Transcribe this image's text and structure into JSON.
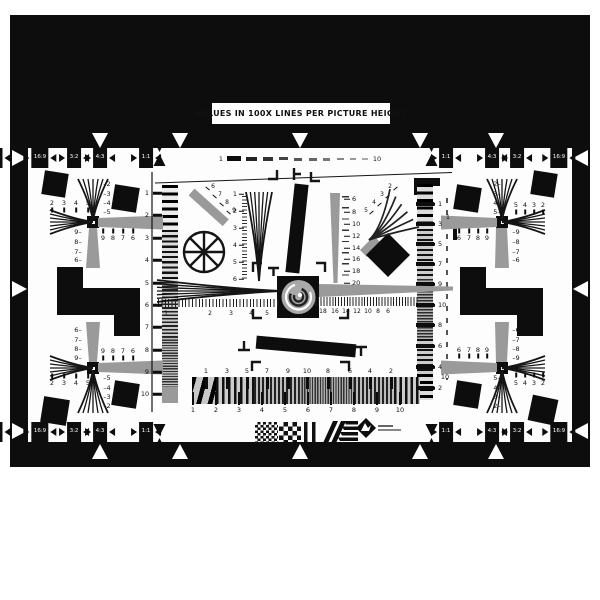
{
  "title": "VALUES IN 100X LINES PER PICTURE HEIGHT",
  "colors": {
    "ink": "#0d0d0d",
    "gray": "#9a9a9a",
    "paper": "#fdfdfd"
  },
  "frame": {
    "aspect_tabs_top": [
      {
        "t": "16:9",
        "x": 40
      },
      {
        "t": "3:2",
        "x": 74
      },
      {
        "t": "4:3",
        "x": 100
      },
      {
        "t": "1:1",
        "x": 146
      },
      {
        "t": "1:1",
        "x": 446
      },
      {
        "t": "4:3",
        "x": 492
      },
      {
        "t": "3:2",
        "x": 517
      },
      {
        "t": "16:9",
        "x": 559
      }
    ],
    "aspect_tabs_bottom": [
      {
        "t": "16:9",
        "x": 40
      },
      {
        "t": "3:2",
        "x": 74
      },
      {
        "t": "4:3",
        "x": 100
      },
      {
        "t": "1:1",
        "x": 146
      },
      {
        "t": "1:1",
        "x": 446
      },
      {
        "t": "4:3",
        "x": 492
      },
      {
        "t": "3:2",
        "x": 517
      },
      {
        "t": "16:9",
        "x": 559
      }
    ],
    "triangles_top": [
      {
        "x": 100
      },
      {
        "x": 180
      },
      {
        "x": 300
      },
      {
        "x": 420
      },
      {
        "x": 496
      }
    ],
    "triangles_bottom": [
      {
        "x": 100
      },
      {
        "x": 180
      },
      {
        "x": 300
      },
      {
        "x": 420
      },
      {
        "x": 496
      }
    ],
    "triangles_left": [
      {
        "y": 158
      },
      {
        "y": 289
      },
      {
        "y": 431
      }
    ],
    "triangles_right": [
      {
        "y": 158
      },
      {
        "y": 289
      },
      {
        "y": 431
      }
    ],
    "hourglasses_top": [
      {
        "x": 160
      },
      {
        "x": 432
      }
    ],
    "hourglasses_bottom": [
      {
        "x": 160
      },
      {
        "x": 432
      }
    ]
  },
  "scales": {
    "top_dash_ruler": [
      {
        "t": "1",
        "x": 221,
        "y": 159
      },
      {
        "t": "10",
        "x": 377,
        "y": 159
      }
    ],
    "left_column": [
      {
        "t": "1",
        "x": 147,
        "y": 193
      },
      {
        "t": "2",
        "x": 147,
        "y": 215
      },
      {
        "t": "3",
        "x": 147,
        "y": 238
      },
      {
        "t": "4",
        "x": 147,
        "y": 260
      },
      {
        "t": "5",
        "x": 147,
        "y": 283
      },
      {
        "t": "6",
        "x": 147,
        "y": 305
      },
      {
        "t": "7",
        "x": 147,
        "y": 327
      },
      {
        "t": "8",
        "x": 147,
        "y": 350
      },
      {
        "t": "9",
        "x": 147,
        "y": 372
      },
      {
        "t": "10",
        "x": 145,
        "y": 394
      }
    ],
    "central_wedge": [
      {
        "t": "1",
        "x": 235,
        "y": 194
      },
      {
        "t": "2",
        "x": 235,
        "y": 211
      },
      {
        "t": "3",
        "x": 235,
        "y": 228
      },
      {
        "t": "4",
        "x": 235,
        "y": 245
      },
      {
        "t": "5",
        "x": 235,
        "y": 262
      },
      {
        "t": "6",
        "x": 235,
        "y": 279
      }
    ],
    "right_wedge": [
      {
        "t": "6",
        "x": 352,
        "y": 199
      },
      {
        "t": "8",
        "x": 352,
        "y": 212
      },
      {
        "t": "10",
        "x": 352,
        "y": 224
      },
      {
        "t": "12",
        "x": 352,
        "y": 236
      },
      {
        "t": "14",
        "x": 352,
        "y": 248
      },
      {
        "t": "16",
        "x": 352,
        "y": 259
      },
      {
        "t": "18",
        "x": 352,
        "y": 271
      },
      {
        "t": "20",
        "x": 352,
        "y": 283
      }
    ],
    "diagonal_bar": [
      {
        "t": "6",
        "x": 213,
        "y": 187
      },
      {
        "t": "7",
        "x": 220,
        "y": 195
      },
      {
        "t": "8",
        "x": 227,
        "y": 203
      },
      {
        "t": "9",
        "x": 234,
        "y": 211
      }
    ],
    "curved_fan": [
      {
        "t": "2",
        "x": 390,
        "y": 187
      },
      {
        "t": "3",
        "x": 382,
        "y": 195
      },
      {
        "t": "4",
        "x": 374,
        "y": 203
      },
      {
        "t": "5",
        "x": 366,
        "y": 211
      }
    ],
    "center_ruler_left": [
      {
        "t": "1",
        "x": 166,
        "y": 314
      },
      {
        "t": "2",
        "x": 210,
        "y": 314
      },
      {
        "t": "3",
        "x": 231,
        "y": 314
      },
      {
        "t": "4",
        "x": 251,
        "y": 314
      },
      {
        "t": "5",
        "x": 267,
        "y": 314
      }
    ],
    "center_ruler_right": [
      {
        "t": "18",
        "x": 323,
        "y": 312
      },
      {
        "t": "16",
        "x": 335,
        "y": 312
      },
      {
        "t": "14",
        "x": 346,
        "y": 312
      },
      {
        "t": "12",
        "x": 357,
        "y": 312
      },
      {
        "t": "10",
        "x": 368,
        "y": 312
      },
      {
        "t": "8",
        "x": 378,
        "y": 312
      },
      {
        "t": "6",
        "x": 388,
        "y": 312
      }
    ],
    "right_sweep": [
      {
        "t": "1",
        "x": 438,
        "y": 204
      },
      {
        "t": "3",
        "x": 438,
        "y": 224
      },
      {
        "t": "5",
        "x": 438,
        "y": 244
      },
      {
        "t": "7",
        "x": 438,
        "y": 264
      },
      {
        "t": "9",
        "x": 438,
        "y": 284
      },
      {
        "t": "10",
        "x": 438,
        "y": 305
      },
      {
        "t": "8",
        "x": 438,
        "y": 325
      },
      {
        "t": "6",
        "x": 438,
        "y": 346
      },
      {
        "t": "4",
        "x": 438,
        "y": 367
      },
      {
        "t": "2",
        "x": 438,
        "y": 388
      }
    ],
    "right_dash_line": [
      {
        "t": "1",
        "x": 448,
        "y": 217
      },
      {
        "t": "10",
        "x": 445,
        "y": 377
      }
    ],
    "bottom_sweep_top": [
      {
        "t": "1",
        "x": 206,
        "y": 371
      },
      {
        "t": "3",
        "x": 227,
        "y": 371
      },
      {
        "t": "5",
        "x": 247,
        "y": 371
      },
      {
        "t": "7",
        "x": 267,
        "y": 371
      },
      {
        "t": "9",
        "x": 288,
        "y": 371
      },
      {
        "t": "10",
        "x": 307,
        "y": 371
      },
      {
        "t": "8",
        "x": 328,
        "y": 371
      },
      {
        "t": "6",
        "x": 350,
        "y": 371
      },
      {
        "t": "4",
        "x": 370,
        "y": 371
      },
      {
        "t": "2",
        "x": 391,
        "y": 371
      }
    ],
    "bottom_sweep_bottom": [
      {
        "t": "1",
        "x": 193,
        "y": 410
      },
      {
        "t": "2",
        "x": 216,
        "y": 410
      },
      {
        "t": "3",
        "x": 239,
        "y": 410
      },
      {
        "t": "4",
        "x": 262,
        "y": 410
      },
      {
        "t": "5",
        "x": 285,
        "y": 410
      },
      {
        "t": "6",
        "x": 308,
        "y": 410
      },
      {
        "t": "7",
        "x": 331,
        "y": 410
      },
      {
        "t": "8",
        "x": 354,
        "y": 410
      },
      {
        "t": "9",
        "x": 377,
        "y": 410
      },
      {
        "t": "10",
        "x": 400,
        "y": 410
      }
    ]
  },
  "cross_labels": {
    "top_left": [
      {
        "t": "–2",
        "x": 107,
        "y": 184
      },
      {
        "t": "–3",
        "x": 107,
        "y": 194
      },
      {
        "t": "–4",
        "x": 107,
        "y": 203
      },
      {
        "t": "–5",
        "x": 107,
        "y": 212
      },
      {
        "t": "2",
        "x": 52,
        "y": 203
      },
      {
        "t": "3",
        "x": 64,
        "y": 203
      },
      {
        "t": "4",
        "x": 76,
        "y": 203
      },
      {
        "t": "5",
        "x": 88,
        "y": 203
      },
      {
        "t": "9",
        "x": 103,
        "y": 238
      },
      {
        "t": "8",
        "x": 113,
        "y": 238
      },
      {
        "t": "7",
        "x": 123,
        "y": 238
      },
      {
        "t": "6",
        "x": 133,
        "y": 238
      },
      {
        "t": "9–",
        "x": 78,
        "y": 232
      },
      {
        "t": "8–",
        "x": 78,
        "y": 242
      },
      {
        "t": "7–",
        "x": 78,
        "y": 252
      },
      {
        "t": "6–",
        "x": 78,
        "y": 260
      }
    ],
    "top_right": [
      {
        "t": "2–",
        "x": 497,
        "y": 184
      },
      {
        "t": "3–",
        "x": 497,
        "y": 194
      },
      {
        "t": "4–",
        "x": 497,
        "y": 203
      },
      {
        "t": "5–",
        "x": 497,
        "y": 212
      },
      {
        "t": "5",
        "x": 516,
        "y": 205
      },
      {
        "t": "4",
        "x": 525,
        "y": 205
      },
      {
        "t": "3",
        "x": 534,
        "y": 205
      },
      {
        "t": "2",
        "x": 543,
        "y": 205
      },
      {
        "t": "6",
        "x": 459,
        "y": 238
      },
      {
        "t": "7",
        "x": 469,
        "y": 238
      },
      {
        "t": "8",
        "x": 478,
        "y": 238
      },
      {
        "t": "9",
        "x": 487,
        "y": 238
      },
      {
        "t": "–9",
        "x": 516,
        "y": 232
      },
      {
        "t": "–8",
        "x": 516,
        "y": 242
      },
      {
        "t": "–7",
        "x": 516,
        "y": 252
      },
      {
        "t": "–6",
        "x": 516,
        "y": 260
      }
    ],
    "bottom_left": [
      {
        "t": "6–",
        "x": 78,
        "y": 330
      },
      {
        "t": "7–",
        "x": 78,
        "y": 340
      },
      {
        "t": "8–",
        "x": 78,
        "y": 349
      },
      {
        "t": "9–",
        "x": 78,
        "y": 358
      },
      {
        "t": "9",
        "x": 103,
        "y": 351
      },
      {
        "t": "8",
        "x": 113,
        "y": 351
      },
      {
        "t": "7",
        "x": 123,
        "y": 351
      },
      {
        "t": "6",
        "x": 133,
        "y": 351
      },
      {
        "t": "2",
        "x": 52,
        "y": 383
      },
      {
        "t": "3",
        "x": 64,
        "y": 383
      },
      {
        "t": "4",
        "x": 76,
        "y": 383
      },
      {
        "t": "5",
        "x": 88,
        "y": 383
      },
      {
        "t": "–5",
        "x": 107,
        "y": 378
      },
      {
        "t": "–4",
        "x": 107,
        "y": 388
      },
      {
        "t": "–3",
        "x": 107,
        "y": 397
      },
      {
        "t": "–2",
        "x": 107,
        "y": 406
      }
    ],
    "bottom_right": [
      {
        "t": "–6",
        "x": 516,
        "y": 330
      },
      {
        "t": "–7",
        "x": 516,
        "y": 340
      },
      {
        "t": "–8",
        "x": 516,
        "y": 349
      },
      {
        "t": "–9",
        "x": 516,
        "y": 358
      },
      {
        "t": "6",
        "x": 459,
        "y": 350
      },
      {
        "t": "7",
        "x": 469,
        "y": 350
      },
      {
        "t": "8",
        "x": 478,
        "y": 350
      },
      {
        "t": "9",
        "x": 487,
        "y": 350
      },
      {
        "t": "5",
        "x": 516,
        "y": 383
      },
      {
        "t": "4",
        "x": 525,
        "y": 383
      },
      {
        "t": "3",
        "x": 534,
        "y": 383
      },
      {
        "t": "2",
        "x": 543,
        "y": 383
      },
      {
        "t": "5–",
        "x": 497,
        "y": 378
      },
      {
        "t": "4–",
        "x": 497,
        "y": 388
      },
      {
        "t": "3–",
        "x": 497,
        "y": 397
      },
      {
        "t": "2–",
        "x": 497,
        "y": 406
      }
    ]
  },
  "cross_ticks": [
    {
      "x": 52,
      "y": 210
    },
    {
      "x": 64,
      "y": 210
    },
    {
      "x": 76,
      "y": 210
    },
    {
      "x": 88,
      "y": 210
    },
    {
      "x": 103,
      "y": 231
    },
    {
      "x": 113,
      "y": 231
    },
    {
      "x": 123,
      "y": 231
    },
    {
      "x": 133,
      "y": 231
    },
    {
      "x": 516,
      "y": 212
    },
    {
      "x": 525,
      "y": 212
    },
    {
      "x": 534,
      "y": 212
    },
    {
      "x": 543,
      "y": 212
    },
    {
      "x": 459,
      "y": 231
    },
    {
      "x": 469,
      "y": 231
    },
    {
      "x": 478,
      "y": 231
    },
    {
      "x": 487,
      "y": 231
    },
    {
      "x": 103,
      "y": 358
    },
    {
      "x": 113,
      "y": 358
    },
    {
      "x": 123,
      "y": 358
    },
    {
      "x": 133,
      "y": 358
    },
    {
      "x": 52,
      "y": 376
    },
    {
      "x": 64,
      "y": 376
    },
    {
      "x": 76,
      "y": 376
    },
    {
      "x": 88,
      "y": 376
    },
    {
      "x": 459,
      "y": 356
    },
    {
      "x": 469,
      "y": 356
    },
    {
      "x": 478,
      "y": 356
    },
    {
      "x": 487,
      "y": 356
    },
    {
      "x": 516,
      "y": 375
    },
    {
      "x": 525,
      "y": 375
    },
    {
      "x": 534,
      "y": 375
    },
    {
      "x": 543,
      "y": 375
    }
  ]
}
